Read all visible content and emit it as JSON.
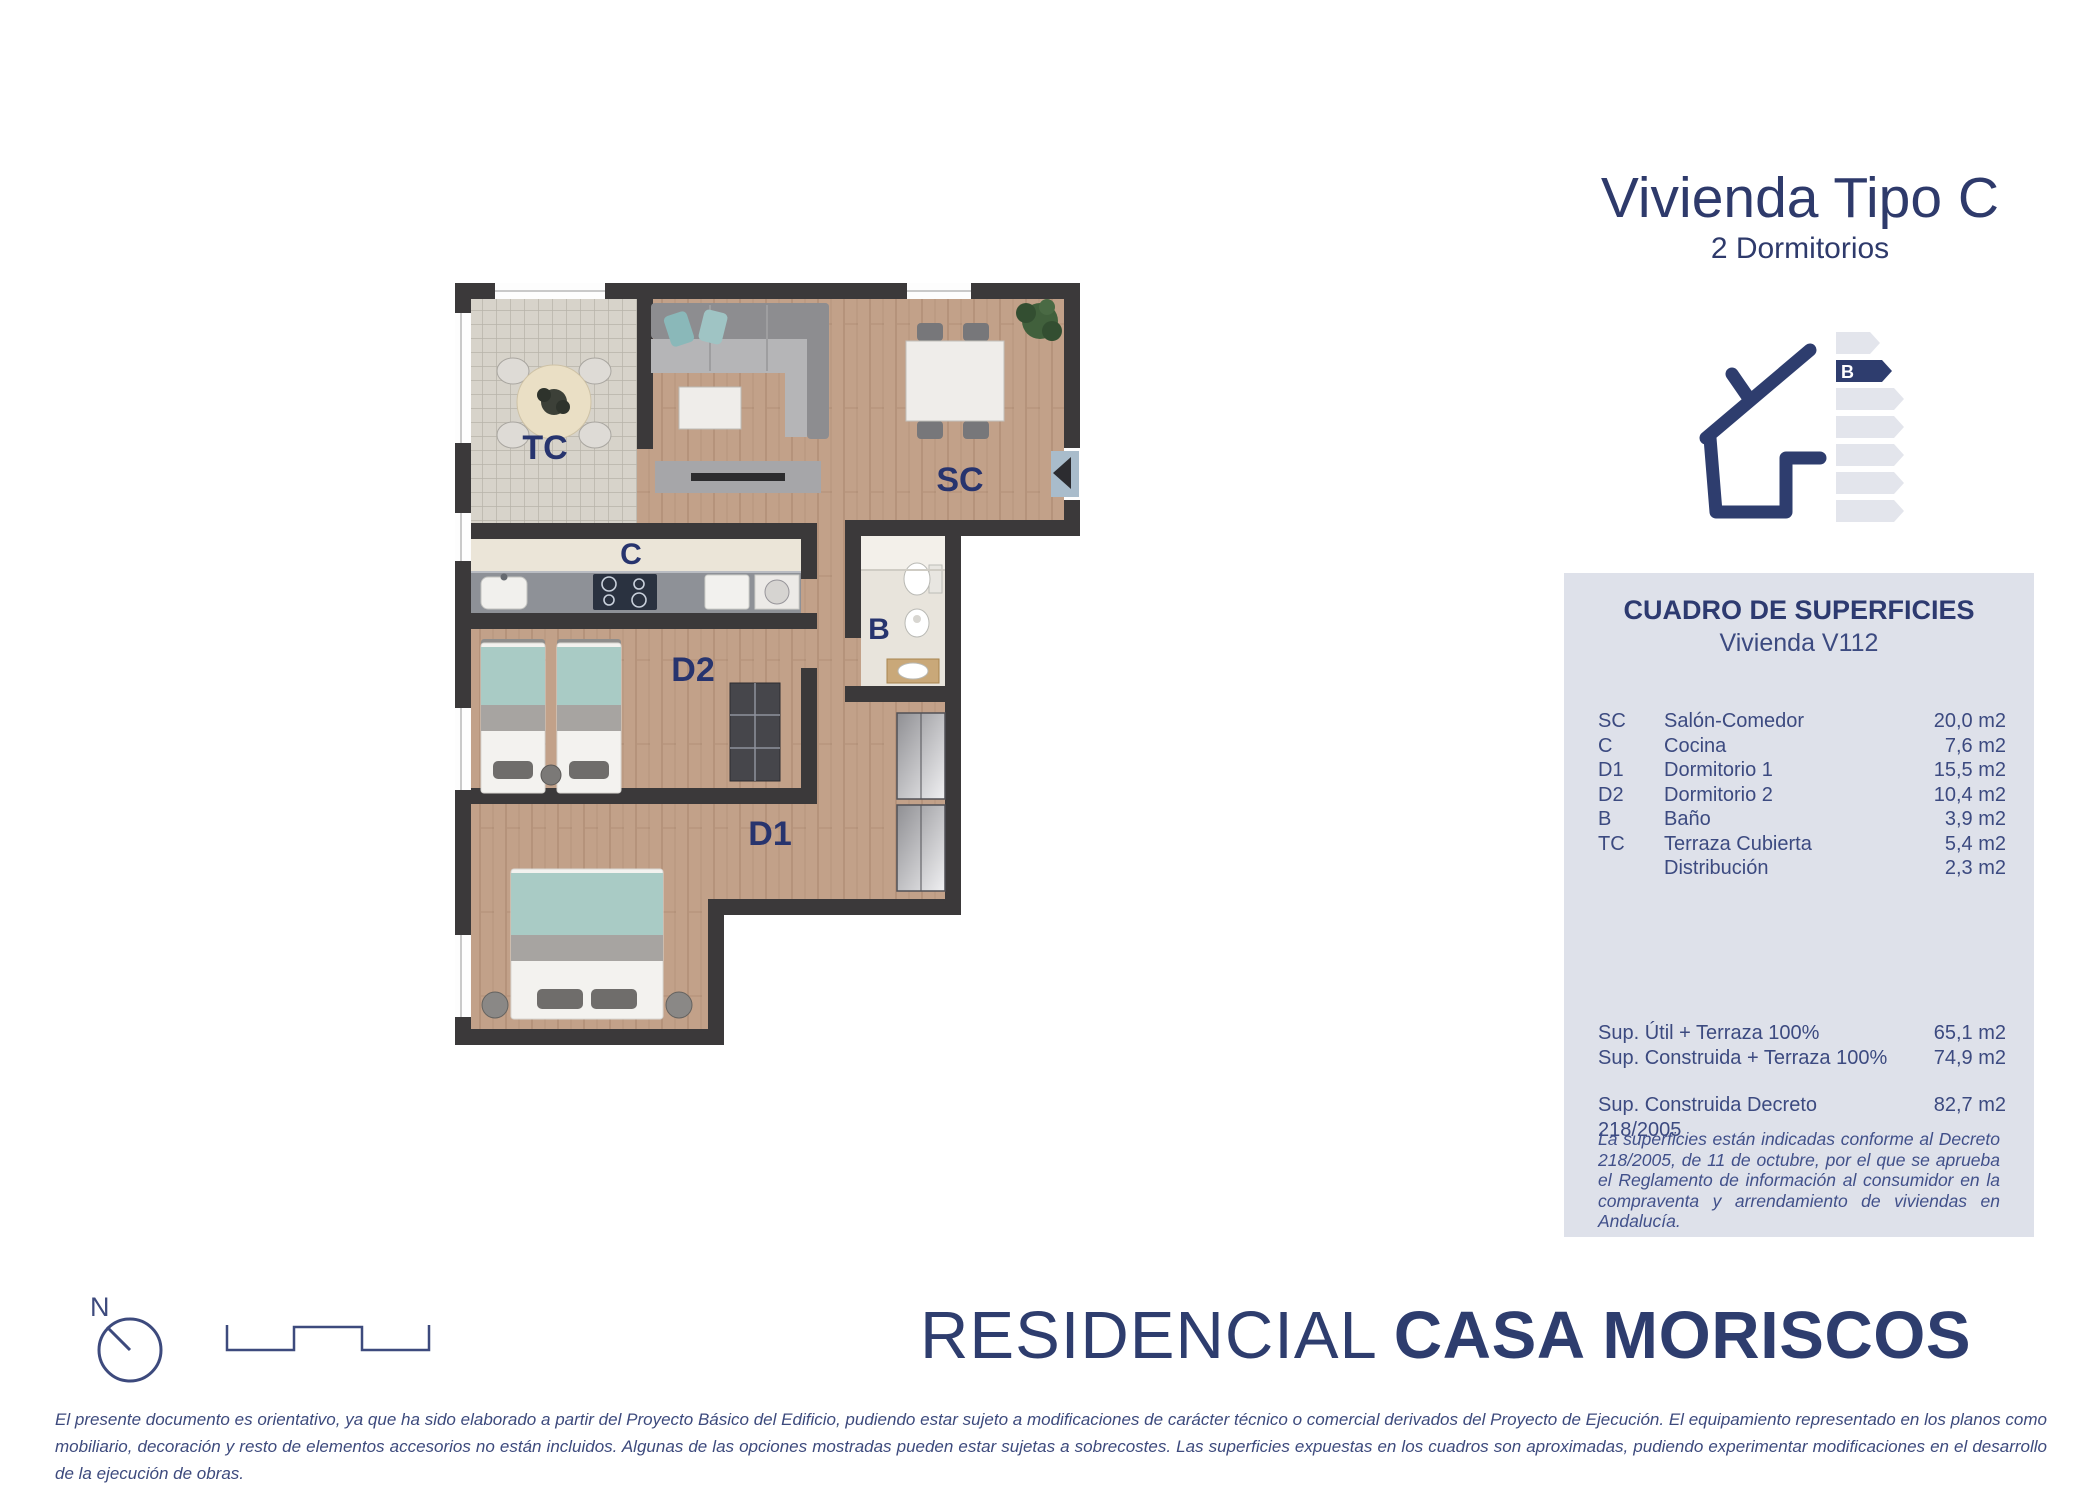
{
  "title": {
    "main": "Vivienda Tipo C",
    "subtitle": "2 Dormitorios"
  },
  "energy": {
    "rating": "B"
  },
  "panel": {
    "heading": "CUADRO DE SUPERFICIES",
    "subheading": "Vivienda V112",
    "rows": [
      {
        "code": "SC",
        "name": "Salón-Comedor",
        "value": "20,0 m2"
      },
      {
        "code": "C",
        "name": "Cocina",
        "value": "7,6 m2"
      },
      {
        "code": "D1",
        "name": "Dormitorio 1",
        "value": "15,5 m2"
      },
      {
        "code": "D2",
        "name": "Dormitorio 2",
        "value": "10,4 m2"
      },
      {
        "code": "B",
        "name": "Baño",
        "value": "3,9 m2"
      },
      {
        "code": "TC",
        "name": "Terraza Cubierta",
        "value": "5,4 m2"
      },
      {
        "code": "",
        "name": "Distribución",
        "value": "2,3 m2"
      }
    ],
    "totals": [
      {
        "label": "Sup. Útil + Terraza 100%",
        "value": "65,1 m2"
      },
      {
        "label": "Sup. Construida + Terraza 100%",
        "value": "74,9 m2"
      }
    ],
    "total_decreto": {
      "label": "Sup. Construida Decreto 218/2005",
      "value": "82,7 m2"
    },
    "note": "La superficies están indicadas conforme al Decreto 218/2005, de 11 de octubre, por el que se aprueba el Reglamento de información al consumidor en la compraventa y arrendamiento de viviendas en Andalucía."
  },
  "plan": {
    "labels": {
      "tc": "TC",
      "sc": "SC",
      "c": "C",
      "b": "B",
      "d2": "D2",
      "d1": "D1"
    }
  },
  "compass": {
    "north": "N"
  },
  "brand": {
    "prefix": "RESIDENCIAL",
    "name": "CASA MORISCOS"
  },
  "footer": {
    "disclaimer": "El presente documento es orientativo, ya que ha sido elaborado a partir del Proyecto Básico del Edificio, pudiendo estar sujeto a modificaciones de carácter técnico o comercial derivados del Proyecto de Ejecución. El equipamiento representado en los planos como mobiliario, decoración y resto de elementos accesorios no están incluidos. Algunas de las opciones mostradas pueden estar sujetas a sobrecostes. Las superficies expuestas en los cuadros son aproximadas, pudiendo experimentar modificaciones en el desarrollo de la ejecución de obras."
  },
  "colors": {
    "navy": "#2e3d6e",
    "panel_bg": "#dee1ea",
    "wall": "#3b393a",
    "wood": "#c2a189",
    "tile": "#d7d3ca",
    "teal": "#a9cbc5",
    "kitchen_floor": "#ebe5d8"
  }
}
